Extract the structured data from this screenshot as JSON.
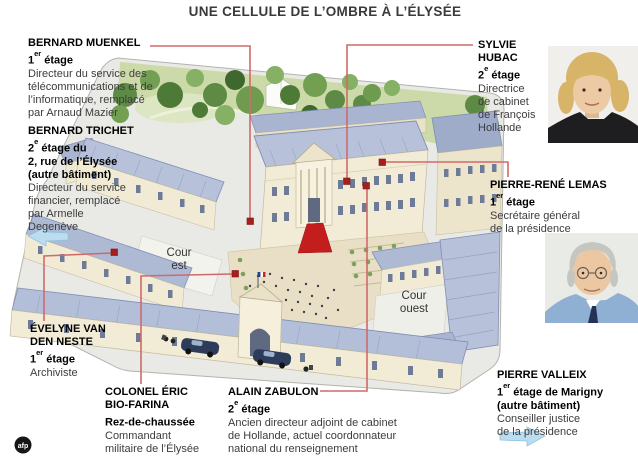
{
  "title": "UNE CELLULE DE L’OMBRE À L’ÉLYSÉE",
  "credit_logo": "afp",
  "map": {
    "courtyard_east_label": "Cour est",
    "courtyard_west_label": "Cour ouest"
  },
  "people": [
    {
      "name": "BERNARD MUENKEL",
      "floor": {
        "num": "1",
        "sup": "er",
        "rest": " étage"
      },
      "bold_extra": "",
      "desc": "Directeur du service des\ntélécommunications et de\nl’informatique, remplacé\npar Arnaud Mazier"
    },
    {
      "name": "BERNARD TRICHET",
      "floor": {
        "num": "2",
        "sup": "e",
        "rest": " étage du"
      },
      "bold_extra": "2, rue de l’Élysée\n(autre bâtiment)",
      "desc": "Directeur du service\nfinancier, remplacé\npar Armelle\nDegenève"
    },
    {
      "name": "ÉVELYNE VAN\nDEN NESTE",
      "floor": {
        "num": "1",
        "sup": "er",
        "rest": " étage"
      },
      "bold_extra": "",
      "desc": "Archiviste"
    },
    {
      "name": "COLONEL ÉRIC\nBIO-FARINA",
      "floor": {
        "num": "",
        "sup": "",
        "rest": "Rez-de-chaussée"
      },
      "bold_extra": "",
      "desc": "Commandant\nmilitaire de l’Élysée"
    },
    {
      "name": "ALAIN ZABULON",
      "floor": {
        "num": "2",
        "sup": "e",
        "rest": " étage"
      },
      "bold_extra": "",
      "desc": "Ancien directeur adjoint de cabinet\nde Hollande, actuel coordonnateur\nnational du renseignement"
    },
    {
      "name": "SYLVIE HUBAC",
      "floor": {
        "num": "2",
        "sup": "e",
        "rest": " étage"
      },
      "bold_extra": "",
      "desc": "Directrice\nde cabinet\nde François\nHollande"
    },
    {
      "name": "PIERRE-RENÉ LEMAS",
      "floor": {
        "num": "1",
        "sup": "er",
        "rest": " étage"
      },
      "bold_extra": "",
      "desc": "Secrétaire général\nde la présidence"
    },
    {
      "name": "PIERRE VALLEIX",
      "floor": {
        "num": "1",
        "sup": "er",
        "rest": " étage de Marigny"
      },
      "bold_extra": "(autre bâtiment)",
      "desc": "Conseiller justice\nde la présidence"
    }
  ],
  "colors": {
    "connector": "#d06a6a",
    "marker": "#a81d1d",
    "roof": "#b7c2da",
    "wall": "#f2ecd7",
    "carpet": "#c31d1d",
    "grass": "#ccd9a8",
    "arrow_blue": "#bcdcef"
  }
}
